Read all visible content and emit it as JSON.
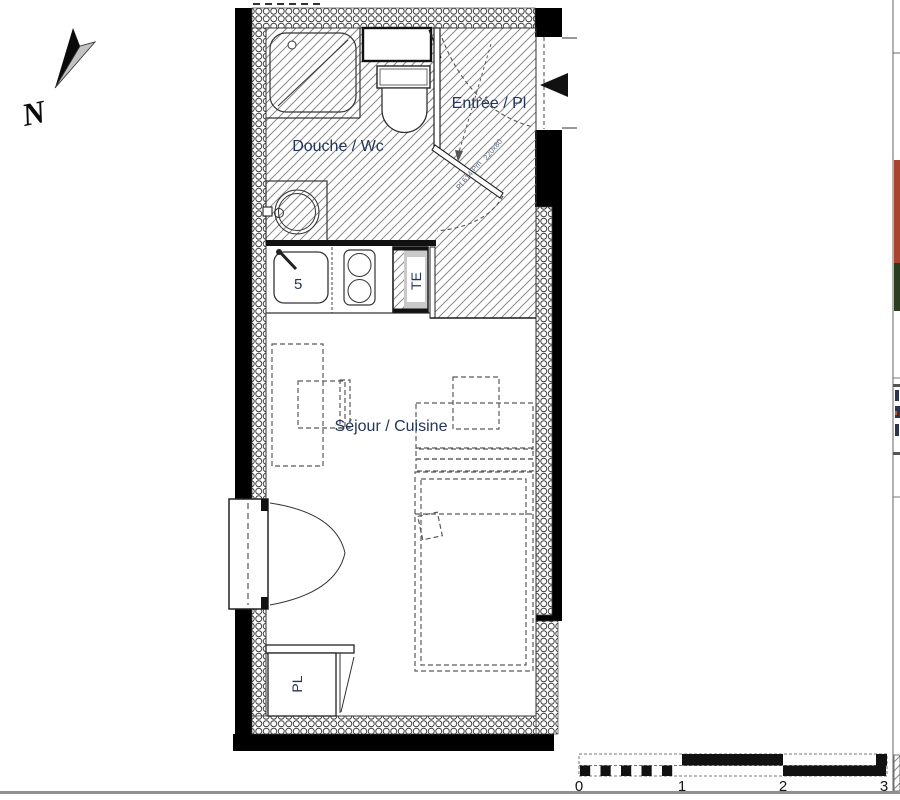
{
  "north": {
    "label": "N"
  },
  "rooms": {
    "bathroom": "Douche / Wc",
    "entrance": "Entrée / Pl",
    "living": "Séjour / Cuisine",
    "closet": "PL",
    "electrical_panel": "TE",
    "sink_ref": "5"
  },
  "door_annotations": {
    "upper": "220x80",
    "lower": "Pf 614 Pm"
  },
  "scale_bar": {
    "ticks": [
      "0",
      "1",
      "2",
      "3"
    ]
  },
  "colors": {
    "wall": "#000000",
    "label_text": "#24355c",
    "annotation_text": "#5a6880",
    "panel_gray": "#c9c9c9",
    "red_strip": "#a8432f",
    "green_strip": "#2a3d20"
  }
}
